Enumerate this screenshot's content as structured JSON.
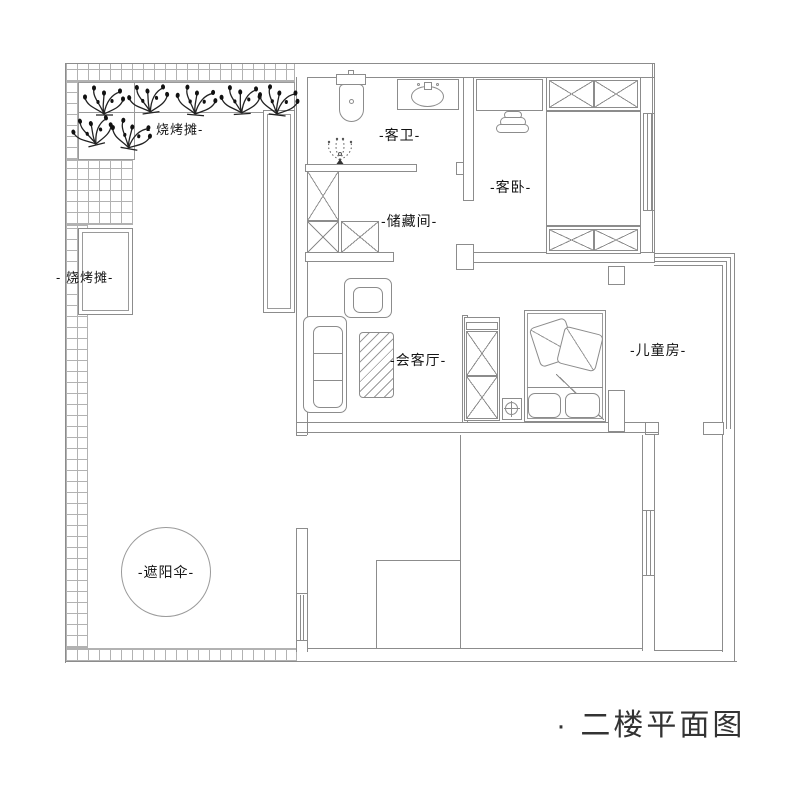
{
  "title": "· 二楼平面图",
  "labels": {
    "bbq_top": "- 烧烤摊-",
    "bbq_left": "- 烧烤摊-",
    "guest_bath": "-客卫-",
    "guest_bedroom": "-客卧-",
    "storage": "-储藏间-",
    "reception": "-会客厅-",
    "kids_room": "-儿童房-",
    "umbrella": "-遮阳伞-"
  },
  "colors": {
    "wall_line": "#8c8c8c",
    "tile_line": "#b2b2b2",
    "label_text": "#141414",
    "title_text": "#333333"
  }
}
